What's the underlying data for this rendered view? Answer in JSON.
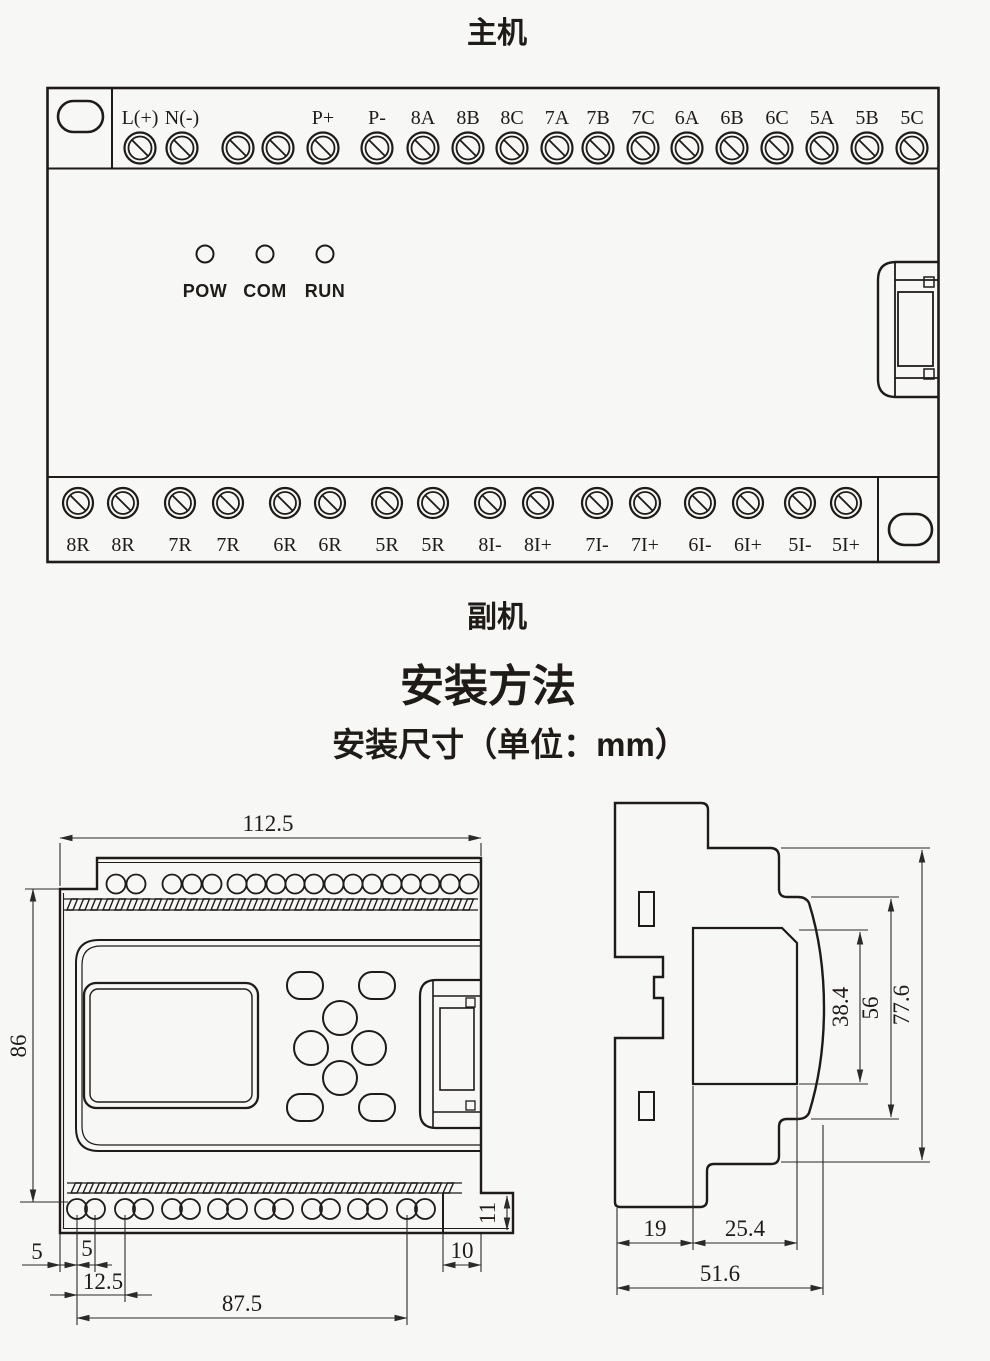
{
  "sections": {
    "main_unit_title": "主机",
    "secondary_unit_title": "副机",
    "install_heading": "安装方法",
    "install_subheading": "安装尺寸（单位：mm）"
  },
  "device": {
    "top_terminals": [
      {
        "x": 140,
        "label": "L(+)"
      },
      {
        "x": 182,
        "label": "N(-)"
      },
      {
        "x": 238,
        "label": ""
      },
      {
        "x": 278,
        "label": ""
      },
      {
        "x": 323,
        "label": "P+"
      },
      {
        "x": 377,
        "label": "P-"
      },
      {
        "x": 423,
        "label": "8A"
      },
      {
        "x": 468,
        "label": "8B"
      },
      {
        "x": 512,
        "label": "8C"
      },
      {
        "x": 557,
        "label": "7A"
      },
      {
        "x": 598,
        "label": "7B"
      },
      {
        "x": 643,
        "label": "7C"
      },
      {
        "x": 687,
        "label": "6A"
      },
      {
        "x": 732,
        "label": "6B"
      },
      {
        "x": 777,
        "label": "6C"
      },
      {
        "x": 822,
        "label": "5A"
      },
      {
        "x": 867,
        "label": "5B"
      },
      {
        "x": 912,
        "label": "5C"
      }
    ],
    "bottom_terminals": [
      {
        "x": 78,
        "label": "8R"
      },
      {
        "x": 123,
        "label": "8R"
      },
      {
        "x": 180,
        "label": "7R"
      },
      {
        "x": 228,
        "label": "7R"
      },
      {
        "x": 285,
        "label": "6R"
      },
      {
        "x": 330,
        "label": "6R"
      },
      {
        "x": 387,
        "label": "5R"
      },
      {
        "x": 433,
        "label": "5R"
      },
      {
        "x": 490,
        "label": "8I-"
      },
      {
        "x": 538,
        "label": "8I+"
      },
      {
        "x": 597,
        "label": "7I-"
      },
      {
        "x": 645,
        "label": "7I+"
      },
      {
        "x": 700,
        "label": "6I-"
      },
      {
        "x": 748,
        "label": "6I+"
      },
      {
        "x": 800,
        "label": "5I-"
      },
      {
        "x": 846,
        "label": "5I+"
      }
    ],
    "leds": [
      {
        "x": 205,
        "label": "POW"
      },
      {
        "x": 265,
        "label": "COM"
      },
      {
        "x": 325,
        "label": "RUN"
      }
    ]
  },
  "front_view": {
    "width": "112.5",
    "height": "86",
    "edge_to_first_hole": "5",
    "hole_pair_spacing": "5",
    "hole_pitch": "12.5",
    "hole_span": "87.5",
    "tab_width": "10",
    "tab_height": "11"
  },
  "side_view": {
    "rail_depth": "19",
    "front_depth": "25.4",
    "total_depth": "51.6",
    "window_height": "38.4",
    "step_height": "56",
    "total_height": "77.6"
  }
}
